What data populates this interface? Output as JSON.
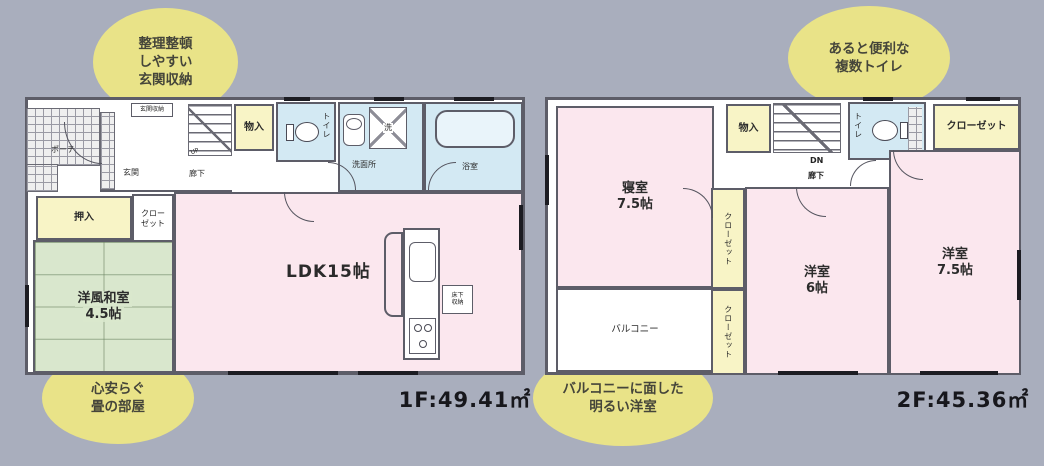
{
  "background": "#a9aebd",
  "colors": {
    "wall": "#5d5d68",
    "room_pink": "#fbe7ee",
    "tatami_green": "#d9e7cd",
    "water_blue": "#d3e9f3",
    "closet_yellow": "#f8f4c6",
    "callout_yellow": "#e9e388"
  },
  "floor1": {
    "area_label": "1F:49.41㎡",
    "porch": "ポーチ",
    "entrance": "玄関",
    "entrance_storage": "玄関収納",
    "hallway": "廊下",
    "stairs": "UP",
    "storage": "物入",
    "toilet": "トイレ",
    "washroom": "洗面所",
    "laundry": "洗",
    "bathroom": "浴室",
    "oshiire": "押入",
    "closet": [
      "クロー",
      "ゼット"
    ],
    "tatami_room": [
      "洋風和室",
      "4.5帖"
    ],
    "ldk": "LDK15帖",
    "underfloor_storage": [
      "床下",
      "収納"
    ]
  },
  "floor2": {
    "area_label": "2F:45.36㎡",
    "bedroom": [
      "寝室",
      "7.5帖"
    ],
    "balcony": "バルコニー",
    "storage": "物入",
    "stairs": "DN",
    "hallway": "廊下",
    "toilet": "トイレ",
    "closet_top": "クローゼット",
    "closet_mid": "クローゼット",
    "closet_bottom": "クローゼット",
    "west_room_6": [
      "洋室",
      "6帖"
    ],
    "west_room_75": [
      "洋室",
      "7.5帖"
    ]
  },
  "callouts": {
    "entrance_storage": [
      "整理整頓",
      "しやすい",
      "玄関収納"
    ],
    "tatami": [
      "心安らぐ",
      "畳の部屋"
    ],
    "toilets": [
      "あると便利な",
      "複数トイレ"
    ],
    "balcony_room": [
      "バルコニーに面した",
      "明るい洋室"
    ]
  }
}
